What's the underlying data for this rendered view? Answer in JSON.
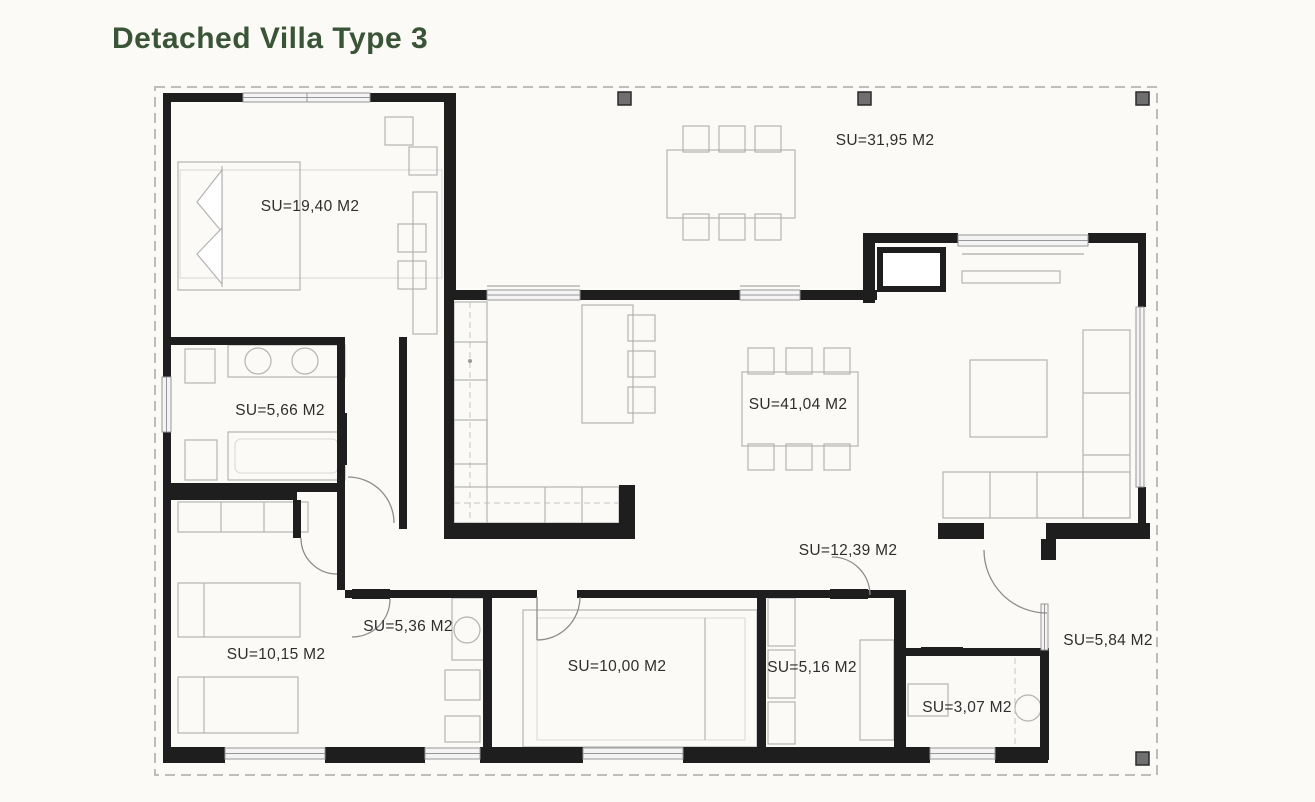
{
  "page": {
    "title": "Detached Villa Type 3",
    "title_color": "#3A5437",
    "background_color": "#FBFAF7",
    "wall_color": "#1E1E1E"
  },
  "plan": {
    "area_unit": "M2",
    "rooms": [
      {
        "id": "master-bedroom",
        "label": "SU=19,40 M2"
      },
      {
        "id": "terrace",
        "label": "SU=31,95 M2"
      },
      {
        "id": "bathroom-main",
        "label": "SU=5,66 M2"
      },
      {
        "id": "living-dining",
        "label": "SU=41,04 M2"
      },
      {
        "id": "hallway",
        "label": "SU=12,39 M2"
      },
      {
        "id": "bedroom-2",
        "label": "SU=10,15 M2"
      },
      {
        "id": "bathroom-2",
        "label": "SU=5,36 M2"
      },
      {
        "id": "bedroom-3",
        "label": "SU=10,00 M2"
      },
      {
        "id": "utility-room",
        "label": "SU=5,16 M2"
      },
      {
        "id": "wc",
        "label": "SU=3,07 M2"
      },
      {
        "id": "side-porch",
        "label": "SU=5,84 M2"
      }
    ]
  }
}
